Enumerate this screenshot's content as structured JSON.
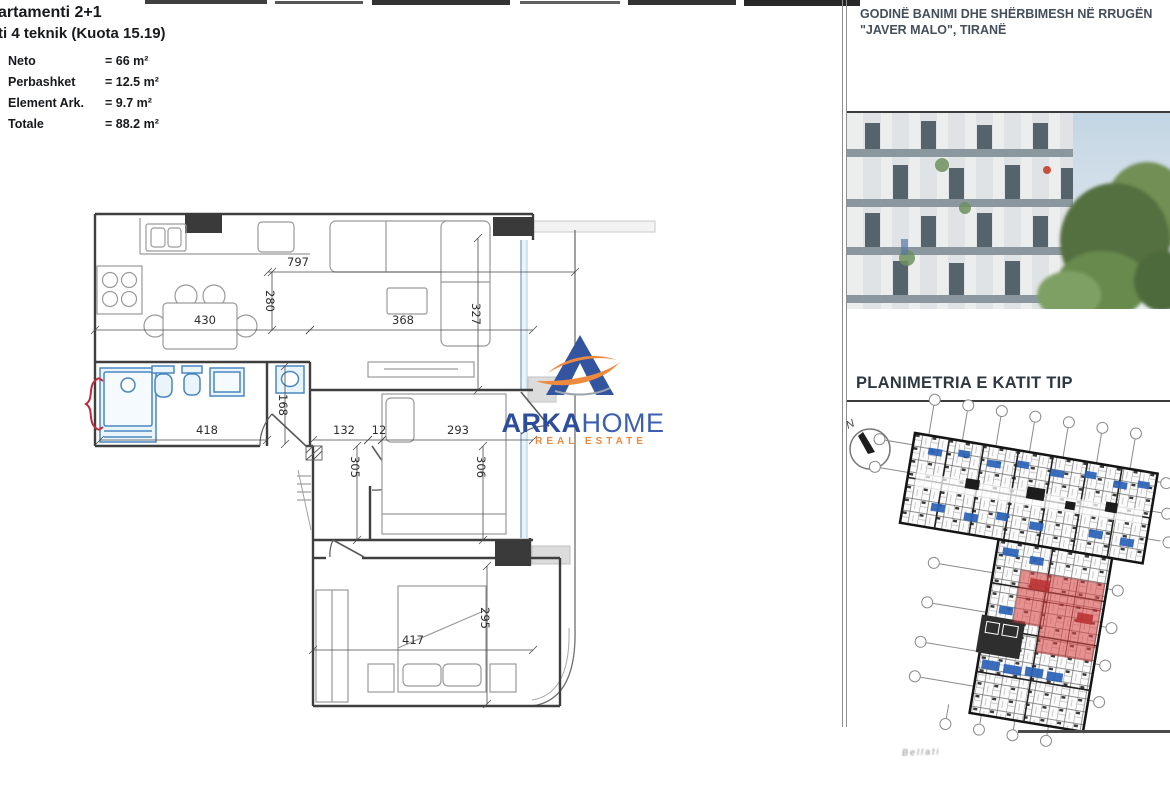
{
  "left_panel": {
    "title_cut_line1": "artamenti 2+1",
    "title_cut_line2": "ti 4 teknik (Kuota 15.19)",
    "areas": [
      {
        "label": "Neto",
        "value": "= 66 m²"
      },
      {
        "label": "Perbashket",
        "value": "= 12.5 m²"
      },
      {
        "label": "Element Ark.",
        "value": "= 9.7 m²"
      },
      {
        "label": "Totale",
        "value": "= 88.2 m²"
      }
    ]
  },
  "floorplan": {
    "colors": {
      "fixture_blue": "#4a86c0",
      "wall": "#3f3f3f",
      "accent_red": "#c2293a"
    },
    "dimensions": [
      {
        "x1": 268,
        "y1": 272,
        "x2": 575,
        "y2": 272,
        "label": "797",
        "lx": 298,
        "ly": 266
      },
      {
        "x1": 272,
        "y1": 272,
        "x2": 272,
        "y2": 330,
        "label": "280",
        "lx": 266,
        "ly": 301,
        "rot": 90
      },
      {
        "x1": 95,
        "y1": 330,
        "x2": 310,
        "y2": 330,
        "label": "430",
        "lx": 205,
        "ly": 324
      },
      {
        "x1": 310,
        "y1": 330,
        "x2": 533,
        "y2": 330,
        "label": "368",
        "lx": 403,
        "ly": 324
      },
      {
        "x1": 478,
        "y1": 238,
        "x2": 478,
        "y2": 390,
        "label": "327",
        "lx": 472,
        "ly": 314,
        "rot": 90
      },
      {
        "x1": 100,
        "y1": 440,
        "x2": 267,
        "y2": 440,
        "label": "418",
        "lx": 207,
        "ly": 434
      },
      {
        "x1": 285,
        "y1": 366,
        "x2": 285,
        "y2": 444,
        "label": "168",
        "lx": 279,
        "ly": 405,
        "rot": 90
      },
      {
        "x1": 313,
        "y1": 440,
        "x2": 368,
        "y2": 440,
        "label": "132",
        "lx": 344,
        "ly": 434
      },
      {
        "x1": 368,
        "y1": 440,
        "x2": 382,
        "y2": 440,
        "label": "12",
        "lx": 379,
        "ly": 434
      },
      {
        "x1": 382,
        "y1": 440,
        "x2": 533,
        "y2": 440,
        "label": "293",
        "lx": 458,
        "ly": 434
      },
      {
        "x1": 357,
        "y1": 446,
        "x2": 357,
        "y2": 540,
        "label": "305",
        "lx": 351,
        "ly": 467,
        "rot": 90
      },
      {
        "x1": 483,
        "y1": 446,
        "x2": 483,
        "y2": 540,
        "label": "306",
        "lx": 477,
        "ly": 467,
        "rot": 90
      },
      {
        "x1": 487,
        "y1": 566,
        "x2": 487,
        "y2": 704,
        "label": "295",
        "lx": 481,
        "ly": 618,
        "rot": 90
      },
      {
        "x1": 313,
        "y1": 650,
        "x2": 533,
        "y2": 650,
        "label": "417",
        "lx": 413,
        "ly": 644
      }
    ]
  },
  "logo": {
    "brand_bold": "ARKA",
    "brand_light": "HOME",
    "tagline": "REAL ESTATE",
    "blue": "#31519e",
    "orange": "#ee8a3f"
  },
  "right_panel": {
    "header_line1": "GODINË BANIMI DHE SHËRBIMESH  NË RRUGËN",
    "header_line2": "\"JAVER MALO\", TIRANË",
    "section_title": "PLANIMETRIA E KATIT TIP",
    "compass_label": "N",
    "footer_note": "Bellati"
  }
}
